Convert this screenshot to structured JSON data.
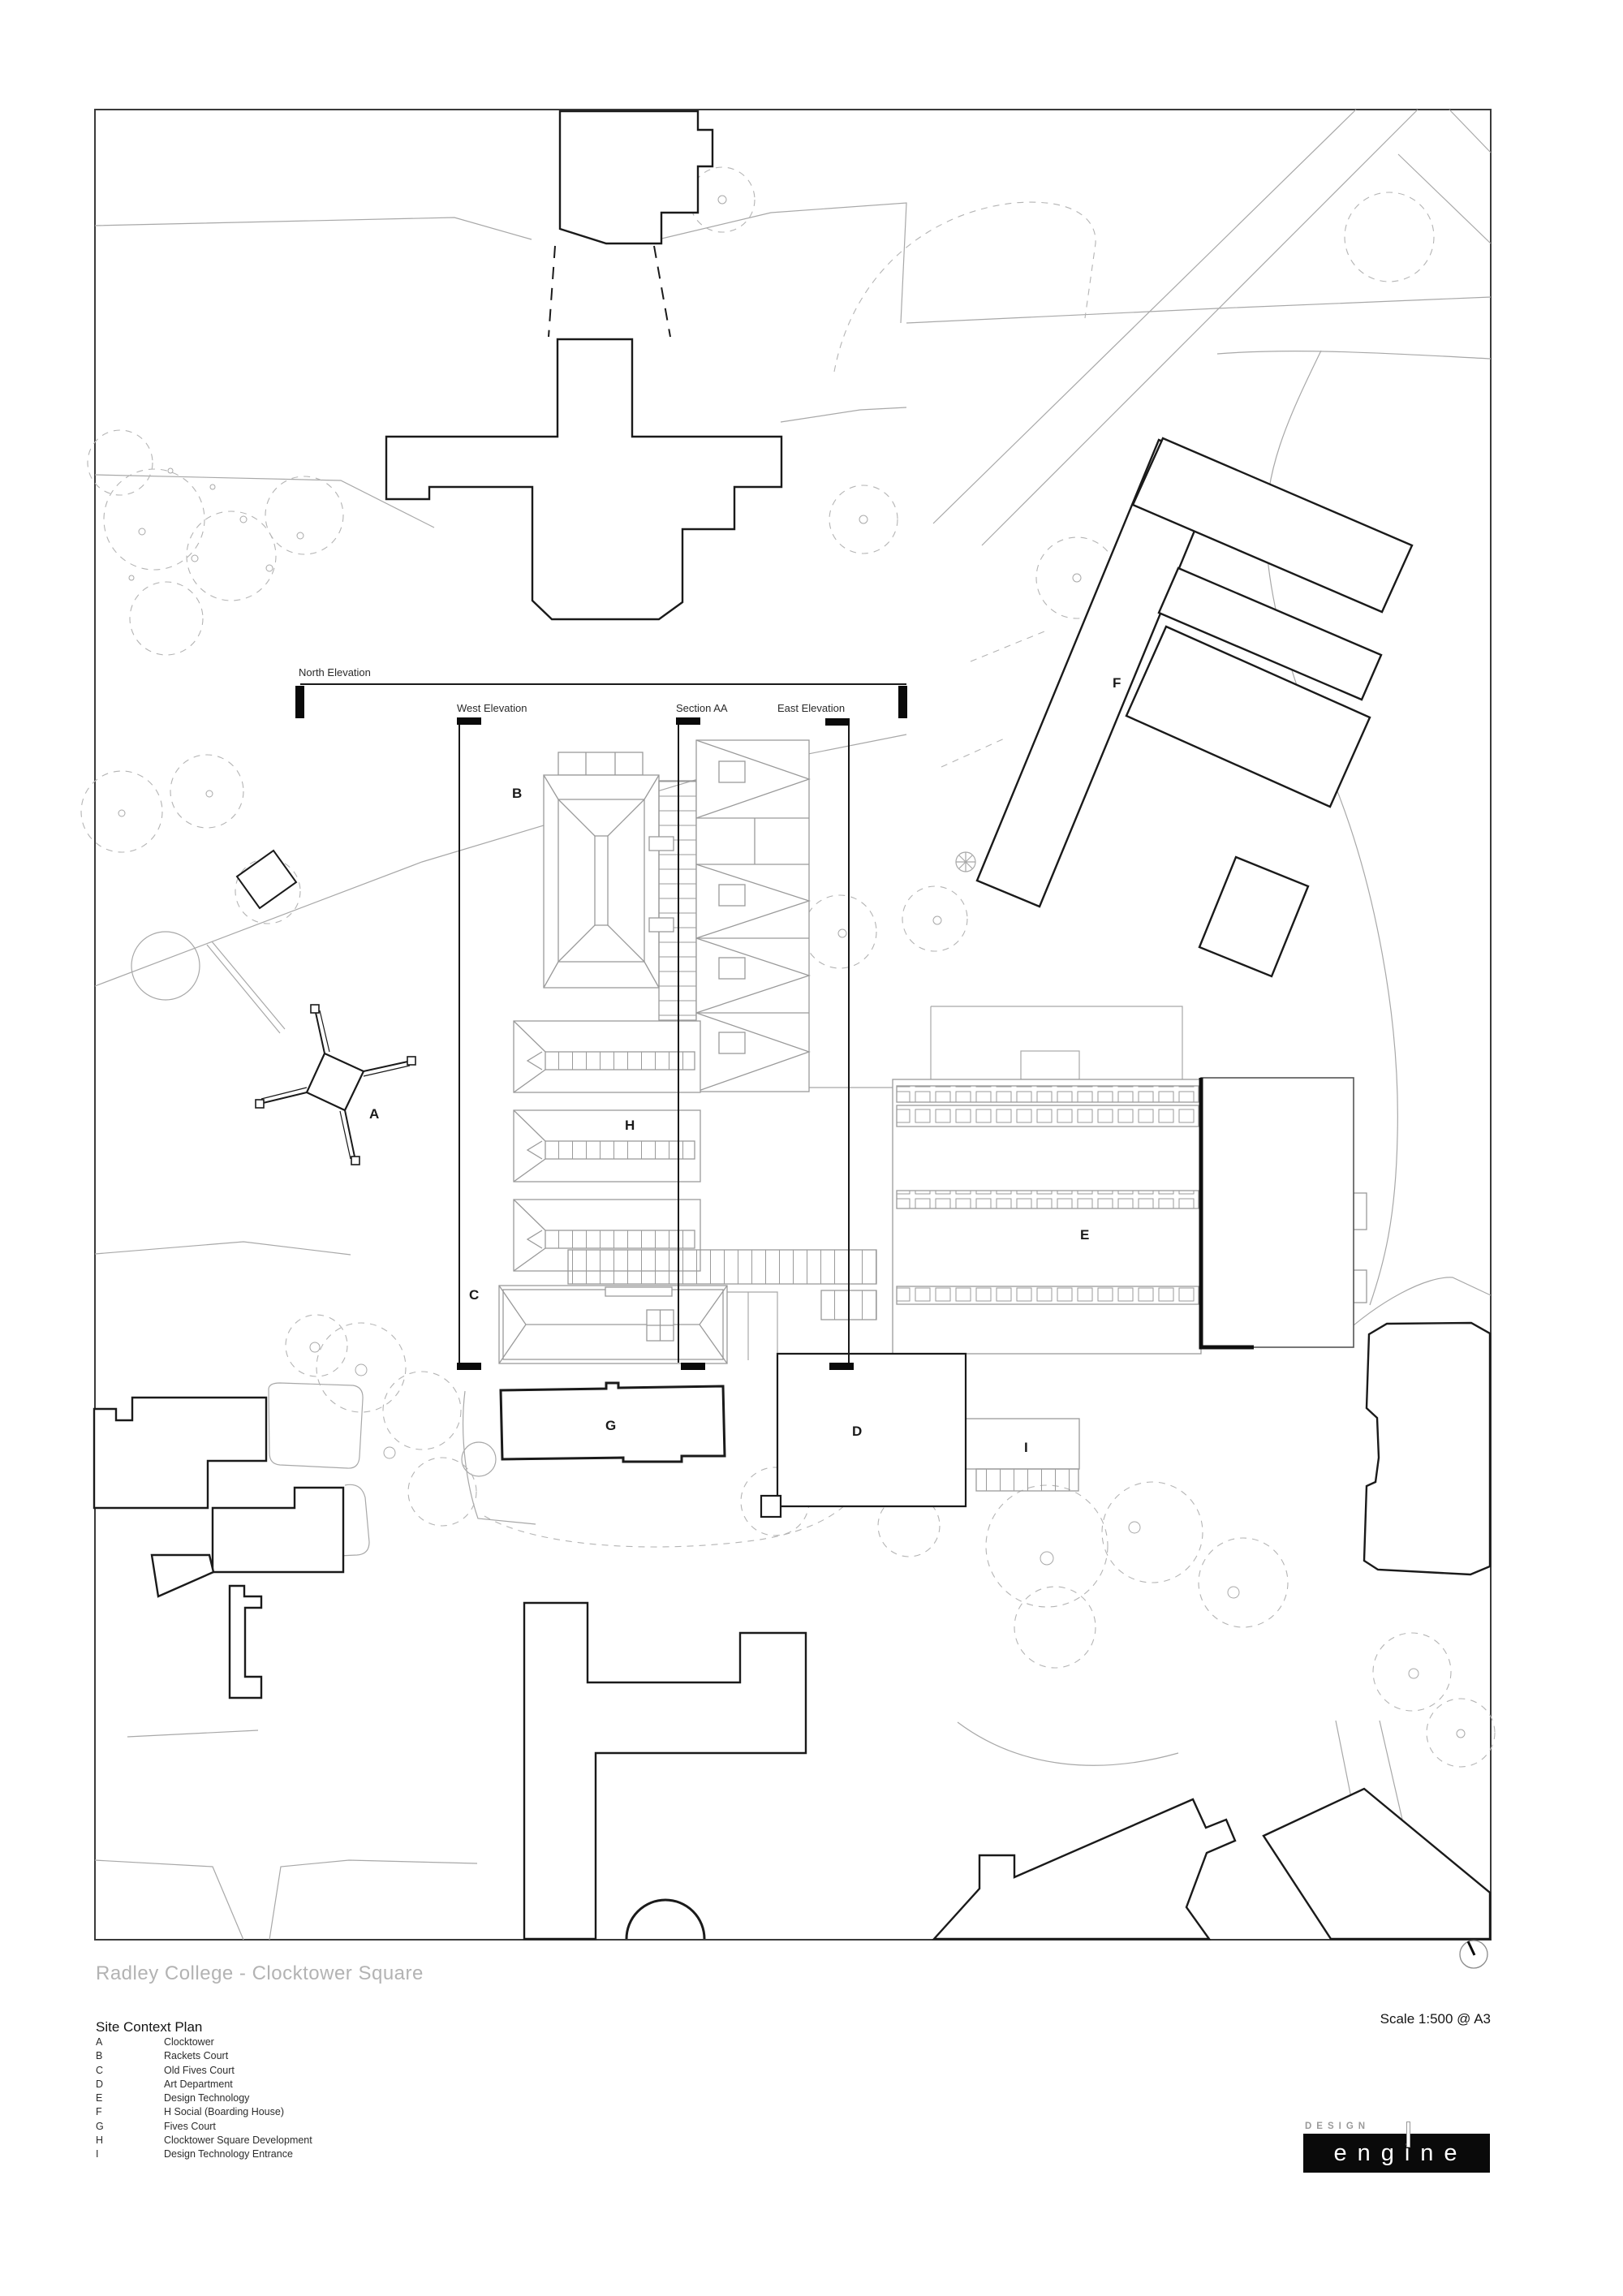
{
  "page": {
    "title": "Radley College - Clocktower Square",
    "subtitle": "Site Context Plan",
    "scale_note": "Scale 1:500 @ A3"
  },
  "plan": {
    "elevation_labels": {
      "north": "North Elevation",
      "west": "West Elevation",
      "section": "Section AA",
      "east": "East Elevation"
    },
    "building_labels": [
      {
        "letter": "A"
      },
      {
        "letter": "B"
      },
      {
        "letter": "C"
      },
      {
        "letter": "D"
      },
      {
        "letter": "E"
      },
      {
        "letter": "F"
      },
      {
        "letter": "G"
      },
      {
        "letter": "H"
      },
      {
        "letter": "I"
      }
    ]
  },
  "legend": {
    "items": [
      {
        "key": "A",
        "label": "Clocktower"
      },
      {
        "key": "B",
        "label": "Rackets Court"
      },
      {
        "key": "C",
        "label": "Old Fives Court"
      },
      {
        "key": "D",
        "label": "Art Department"
      },
      {
        "key": "E",
        "label": "Design Technology"
      },
      {
        "key": "F",
        "label": "H Social (Boarding House)"
      },
      {
        "key": "G",
        "label": "Fives Court"
      },
      {
        "key": "H",
        "label": "Clocktower Square Development"
      },
      {
        "key": "I",
        "label": "Design Technology Entrance"
      }
    ]
  },
  "logo": {
    "top_text": "DESIGN",
    "name": "engine"
  },
  "colors": {
    "ink": "#1a1a1a",
    "mid_gray": "#9a9a9a",
    "light_gray": "#b8b8b8",
    "title_gray": "#b3b3b3"
  }
}
